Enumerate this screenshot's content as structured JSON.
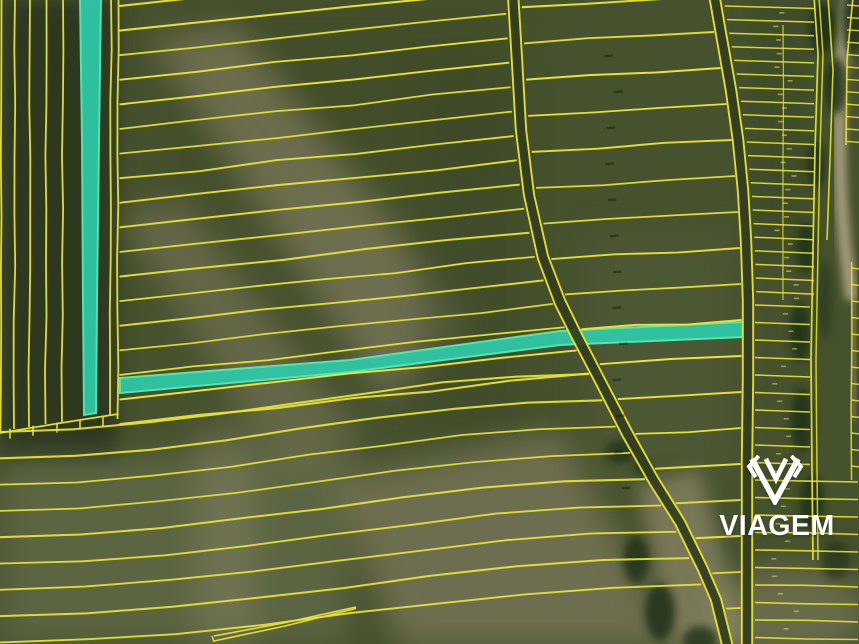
{
  "watermark": {
    "brand": "VIAGEM",
    "logo_icon": "viagem-shield-v-logo"
  },
  "map": {
    "colors": {
      "parcel_line": "#e9e435",
      "highlight_fill": "#2fc7a6",
      "highlight_edge": "#55ecb6",
      "field_base": "#46512e",
      "field_dark": "#27331d",
      "field_shadow": "#3a4626",
      "soil_light": "#948c6f",
      "soil_tan": "#ab9f80",
      "grass_light": "#79815c",
      "tree_dark": "#1f2d17",
      "road_dark": "#323e20",
      "tan_road": "#b9ab8b",
      "watermark_white": "#ffffff"
    }
  }
}
